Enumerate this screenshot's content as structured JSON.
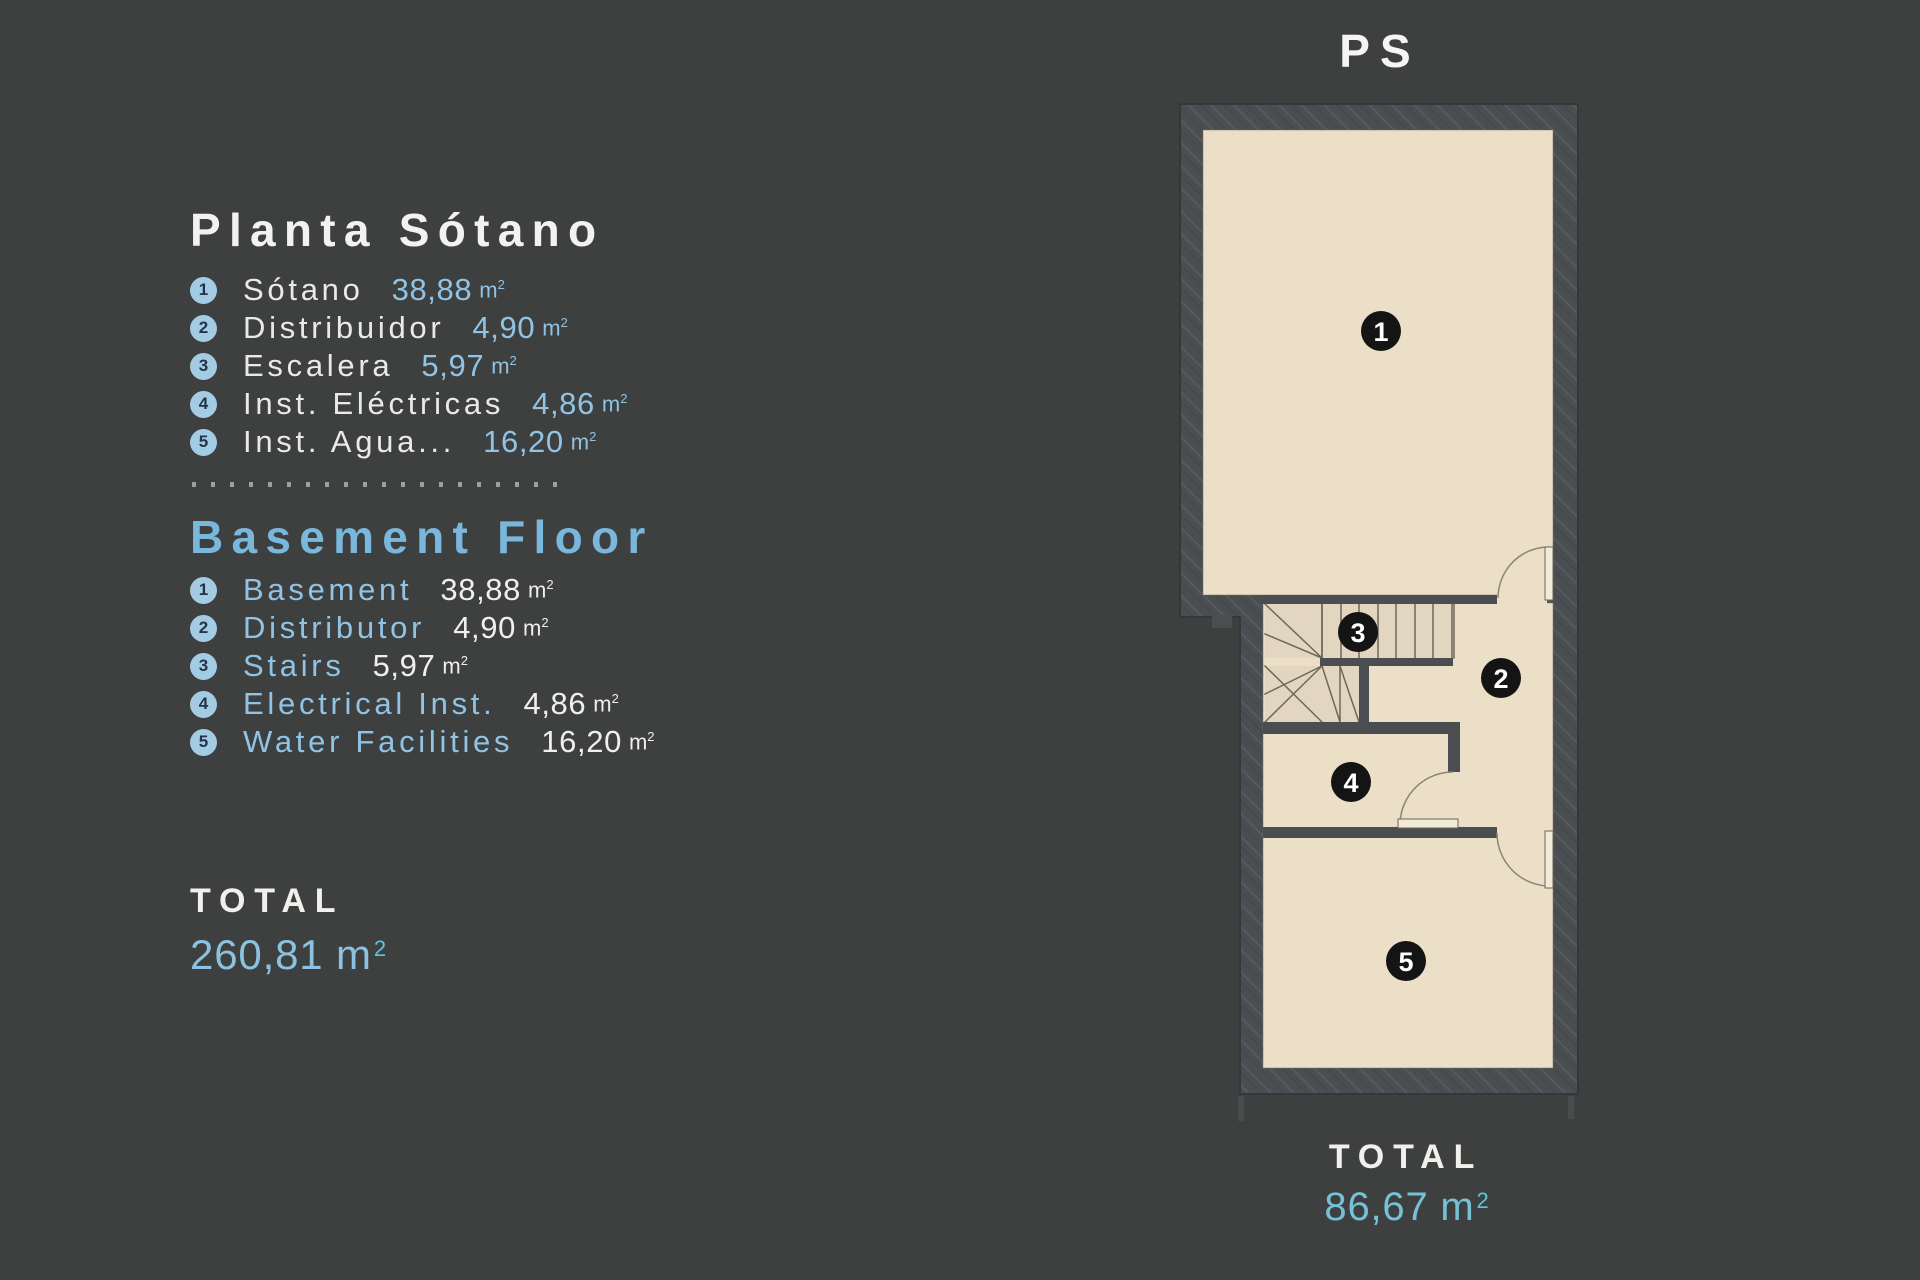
{
  "legend": {
    "title_es": "Planta Sótano",
    "rows_es": [
      {
        "num": "1",
        "name": "Sótano",
        "value": "38,88"
      },
      {
        "num": "2",
        "name": "Distribuidor",
        "value": "4,90"
      },
      {
        "num": "3",
        "name": "Escalera",
        "value": "5,97"
      },
      {
        "num": "4",
        "name": "Inst. Eléctricas",
        "value": "4,86"
      },
      {
        "num": "5",
        "name": "Inst. Agua...",
        "value": "16,20"
      }
    ],
    "title_en": "Basement Floor",
    "rows_en": [
      {
        "num": "1",
        "name": "Basement",
        "value": "38,88"
      },
      {
        "num": "2",
        "name": "Distributor",
        "value": "4,90"
      },
      {
        "num": "3",
        "name": "Stairs",
        "value": "5,97"
      },
      {
        "num": "4",
        "name": "Electrical Inst.",
        "value": "4,86"
      },
      {
        "num": "5",
        "name": "Water Facilities",
        "value": "16,20"
      }
    ],
    "unit": "m",
    "unit_sup": "2",
    "total_label": "TOTAL",
    "total_value": "260,81 m",
    "total_sup": "2"
  },
  "plan": {
    "title": "PS",
    "badges": [
      {
        "num": "1"
      },
      {
        "num": "2"
      },
      {
        "num": "3"
      },
      {
        "num": "4"
      },
      {
        "num": "5"
      }
    ],
    "total_label": "TOTAL",
    "total_value": "86,67 m",
    "total_sup": "2"
  },
  "colors": {
    "background": "#3e4040",
    "wall": "#4b4e51",
    "floor": "#ecdfc8",
    "stairs_floor": "#e3d6c0",
    "accent_blue": "#90c3e4",
    "accent_title_blue": "#7ab7dc",
    "accent_teal_sup": "#56c9d9",
    "badge_legend_bg": "#a3cbe4",
    "badge_plan_bg": "#141414",
    "text_white": "#f2f2f0"
  }
}
